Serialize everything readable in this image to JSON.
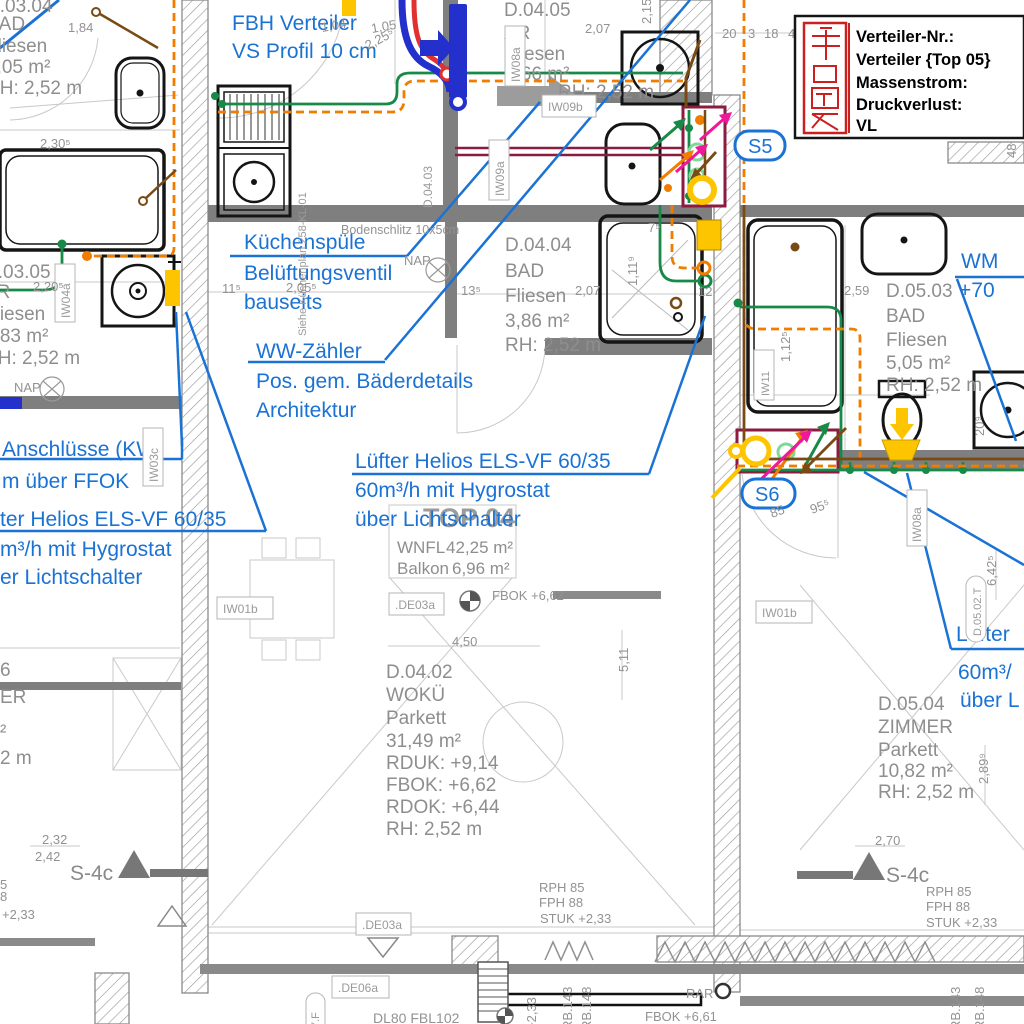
{
  "legend": {
    "rows": [
      "Verteiler-Nr.:",
      "Verteiler {Top 05}",
      "Massenstrom:",
      "Druckverlust:",
      "VL"
    ]
  },
  "annotations": {
    "fbh": [
      "FBH Verteiler",
      "VS Profil 10 cm"
    ],
    "kueche": [
      "Küchenspüle",
      "Belüftungsventil",
      "bauseits"
    ],
    "ww": [
      "WW-Zähler",
      "Pos. gem. Bäderdetails",
      "Architektur"
    ],
    "luefter": [
      "Lüfter Helios ELS-VF 60/35",
      "60m³/h mit Hygrostat",
      "über Lichtschalter"
    ],
    "left_kw": [
      "Anschlüsse (KW)",
      "m über FFOK"
    ],
    "left_luefter": [
      "ter Helios ELS-VF 60/35",
      "m³/h mit Hygrostat",
      "er Lichtschalter"
    ],
    "right_wm": [
      "WM",
      "+70"
    ],
    "right_luefter": [
      "Lüfter",
      "60m³/",
      "über L"
    ],
    "s5": "S5",
    "s6": "S6"
  },
  "rooms": {
    "d0304": [
      "D.03.04",
      "BAD",
      "Fliesen",
      "4,05 m²",
      "RH: 2,52 m"
    ],
    "d0305": [
      "D.03.05",
      "AR",
      "Fliesen",
      "3,83 m²",
      "RH: 2,52 m"
    ],
    "d0306": [
      "6",
      "ER",
      "²",
      "2 m"
    ],
    "d0405": [
      "D.04.05",
      "AR",
      "Fliesen",
      "1,66 m²",
      "RH: 2,52 m"
    ],
    "d0404": [
      "D.04.04",
      "BAD",
      "Fliesen",
      "3,86 m²",
      "RH: 2,52 m"
    ],
    "d0402": [
      "D.04.02",
      "WOKÜ",
      "Parkett",
      "31,49 m²",
      "RDUK: +9,14",
      "FBOK: +6,62",
      "RDOK: +6,44",
      "RH: 2,52 m"
    ],
    "d0503": [
      "D.05.03",
      "BAD",
      "Fliesen",
      "5,05 m²",
      "RH: 2,52 m"
    ],
    "d0504": [
      "D.05.04",
      "ZIMMER",
      "Parkett",
      "10,82 m²",
      "RH: 2,52 m"
    ]
  },
  "top04": {
    "title": "TOP 04",
    "rows": [
      [
        "WNFL",
        "42,25 m²"
      ],
      [
        "Balkon",
        "6,96 m²"
      ]
    ]
  },
  "marks": {
    "s4c": "S-4c",
    "rph": "RPH 85",
    "fph": "FPH 88",
    "stuk": "STUK +2,33",
    "rph_cut": [
      "5",
      "8",
      "+2,33"
    ],
    "fbok_662": "FBOK +6,62",
    "fbok_661": "FBOK +6,61",
    "de03a": ".DE03a",
    "de06a": ".DE06a",
    "dl": "DL80  FBL102",
    "rar": "RAR",
    "rb143": "RB.143",
    "rb148": "RB.148",
    "p233": "+2,33",
    "zf": "7.F",
    "bodenschlitz": "Bodenschlitz 10x5cm",
    "nap": "NAP",
    "kuechenplan": "Siehe Küchenplan 258-KL-01"
  },
  "wall_ids": {
    "iw09b": "IW09b",
    "iw08a": "IW08a",
    "iw09a": "IW09a",
    "iw04a": "IW04a",
    "iw03c": "IW03c",
    "iw11": "IW11",
    "iw01b": "IW01b",
    "d0403": "D.04.03",
    "d0502t": "D.05.02.T"
  },
  "dims": [
    "1,84",
    "2,30⁵",
    "2,20⁵",
    "1,04",
    "1,05",
    "2,25⁵",
    "2,07",
    "2,15⁵",
    "20",
    "3",
    "18",
    "40",
    "48",
    "11⁵",
    "2,05⁵",
    "13⁵",
    "2,07",
    "1,11⁹",
    "7⁵",
    "12",
    "2,59",
    "1,12⁵",
    "4,50",
    "5,11",
    "2,32",
    "2,42",
    "2,70",
    "2,89⁹",
    "6,42⁵",
    "85",
    "95⁵",
    "20⁹"
  ],
  "colors": {
    "annotation_blue": "#1a72d4",
    "pipe_green": "#178a47",
    "pipe_orange": "#f07d00",
    "pipe_brown": "#7a4a15",
    "pipe_magenta": "#ee189b",
    "pipe_yellow": "#fdc400",
    "pipe_maroon": "#8c1b40",
    "supply_blue": "#2330cc",
    "supply_red": "#e03030",
    "legend_red": "#cc2020",
    "wall_gray": "#7f7f7f",
    "text_gray": "#8c8c8c"
  }
}
